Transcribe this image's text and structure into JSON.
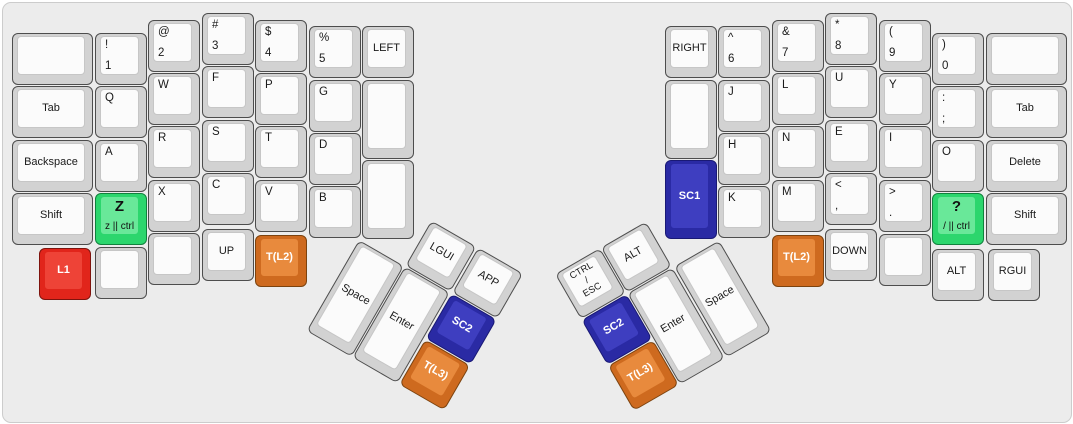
{
  "panel": {
    "bg": "#ececec",
    "border": "#cccccc"
  },
  "colors": {
    "key_base": "#d2d2d2",
    "key_cap": "#fbfbfb",
    "red": "#ee4337",
    "green": "#69e899",
    "orange": "#e88a3d",
    "blue": "#3e3ec0"
  },
  "keys": [
    {
      "name": "key-blank-outer-top-left",
      "x": 9,
      "y": 30,
      "w": 81
    },
    {
      "name": "key-tab-left",
      "x": 9,
      "y": 83,
      "w": 81,
      "center": "Tab"
    },
    {
      "name": "key-backspace",
      "x": 9,
      "y": 137,
      "w": 81,
      "center": "Backspace"
    },
    {
      "name": "key-shift-left",
      "x": 9,
      "y": 190,
      "w": 81,
      "center": "Shift"
    },
    {
      "name": "key-1",
      "x": 92,
      "y": 30,
      "tl": "!",
      "bl": "1"
    },
    {
      "name": "key-q",
      "x": 92,
      "y": 83,
      "tl": "Q"
    },
    {
      "name": "key-a",
      "x": 92,
      "y": 137,
      "tl": "A"
    },
    {
      "name": "key-z-ctrl",
      "x": 92,
      "y": 190,
      "color": "green",
      "big": "Z",
      "sub": "z || ctrl"
    },
    {
      "name": "key-blank-left-col1-bottom",
      "x": 92,
      "y": 244
    },
    {
      "name": "key-2",
      "x": 145,
      "y": 17,
      "tl": "@",
      "bl": "2"
    },
    {
      "name": "key-w",
      "x": 145,
      "y": 70,
      "tl": "W"
    },
    {
      "name": "key-r",
      "x": 145,
      "y": 123,
      "tl": "R"
    },
    {
      "name": "key-x",
      "x": 145,
      "y": 177,
      "tl": "X"
    },
    {
      "name": "key-blank-left-col2-bottom",
      "x": 145,
      "y": 230
    },
    {
      "name": "key-3",
      "x": 199,
      "y": 10,
      "tl": "#",
      "bl": "3"
    },
    {
      "name": "key-f",
      "x": 199,
      "y": 63,
      "tl": "F"
    },
    {
      "name": "key-s",
      "x": 199,
      "y": 117,
      "tl": "S"
    },
    {
      "name": "key-c",
      "x": 199,
      "y": 170,
      "tl": "C"
    },
    {
      "name": "key-up",
      "x": 199,
      "y": 226,
      "center": "UP"
    },
    {
      "name": "key-4",
      "x": 252,
      "y": 17,
      "tl": "$",
      "bl": "4"
    },
    {
      "name": "key-p",
      "x": 252,
      "y": 70,
      "tl": "P"
    },
    {
      "name": "key-t",
      "x": 252,
      "y": 123,
      "tl": "T"
    },
    {
      "name": "key-v",
      "x": 252,
      "y": 177,
      "tl": "V"
    },
    {
      "name": "key-t-l2-left",
      "x": 252,
      "y": 232,
      "color": "orange",
      "center": "T(L2)"
    },
    {
      "name": "key-5",
      "x": 306,
      "y": 23,
      "tl": "%",
      "bl": "5"
    },
    {
      "name": "key-g",
      "x": 306,
      "y": 77,
      "tl": "G"
    },
    {
      "name": "key-d",
      "x": 306,
      "y": 130,
      "tl": "D"
    },
    {
      "name": "key-b",
      "x": 306,
      "y": 183,
      "tl": "B"
    },
    {
      "name": "key-left",
      "x": 359,
      "y": 23,
      "center": "LEFT"
    },
    {
      "name": "key-blank-left-inner-1",
      "x": 359,
      "y": 77,
      "h": 79
    },
    {
      "name": "key-blank-left-inner-2",
      "x": 359,
      "y": 157,
      "h": 79
    },
    {
      "name": "key-l1",
      "x": 36,
      "y": 245,
      "color": "red",
      "center": "L1"
    },
    {
      "name": "key-space-left",
      "x": 356,
      "y": 237,
      "h": 105,
      "rot": 30,
      "ox": 356,
      "oy": 237,
      "center": "Space"
    },
    {
      "name": "key-enter-left",
      "x": 409,
      "y": 237,
      "h": 105,
      "rot": 30,
      "ox": 356,
      "oy": 237,
      "center": "Enter"
    },
    {
      "name": "key-sc2-left",
      "x": 463,
      "y": 237,
      "rot": 30,
      "ox": 356,
      "oy": 237,
      "color": "blue",
      "center": "SC2"
    },
    {
      "name": "key-lgui",
      "x": 409,
      "y": 184,
      "rot": 30,
      "ox": 356,
      "oy": 237,
      "center": "LGUI"
    },
    {
      "name": "key-app",
      "x": 463,
      "y": 184,
      "rot": 30,
      "ox": 356,
      "oy": 237,
      "center": "APP"
    },
    {
      "name": "key-t-l3-left",
      "x": 463,
      "y": 290,
      "rot": 30,
      "ox": 356,
      "oy": 237,
      "color": "orange",
      "center": "T(L3)"
    },
    {
      "name": "key-blank-outer-top-right",
      "x": 983,
      "y": 30,
      "w": 81
    },
    {
      "name": "key-tab-right",
      "x": 983,
      "y": 83,
      "w": 81,
      "center": "Tab"
    },
    {
      "name": "key-delete",
      "x": 983,
      "y": 137,
      "w": 81,
      "center": "Delete"
    },
    {
      "name": "key-shift-right",
      "x": 983,
      "y": 190,
      "w": 81,
      "center": "Shift"
    },
    {
      "name": "key-0",
      "x": 929,
      "y": 30,
      "tl": ")",
      "bl": "0"
    },
    {
      "name": "key-semicolon",
      "x": 929,
      "y": 83,
      "tl": ":",
      "bl": ";"
    },
    {
      "name": "key-o",
      "x": 929,
      "y": 137,
      "tl": "O"
    },
    {
      "name": "key-slash-ctrl",
      "x": 929,
      "y": 190,
      "color": "green",
      "big": "?",
      "sub": "/ || ctrl"
    },
    {
      "name": "key-alt-right",
      "x": 929,
      "y": 246,
      "center": "ALT"
    },
    {
      "name": "key-9",
      "x": 876,
      "y": 17,
      "tl": "(",
      "bl": "9"
    },
    {
      "name": "key-y",
      "x": 876,
      "y": 70,
      "tl": "Y"
    },
    {
      "name": "key-i",
      "x": 876,
      "y": 123,
      "tl": "I"
    },
    {
      "name": "key-period",
      "x": 876,
      "y": 177,
      "tl": ">",
      "bl": "."
    },
    {
      "name": "key-blank-right-col-bottom",
      "x": 876,
      "y": 231
    },
    {
      "name": "key-8",
      "x": 822,
      "y": 10,
      "tl": "*",
      "bl": "8"
    },
    {
      "name": "key-u",
      "x": 822,
      "y": 63,
      "tl": "U"
    },
    {
      "name": "key-e",
      "x": 822,
      "y": 117,
      "tl": "E"
    },
    {
      "name": "key-comma",
      "x": 822,
      "y": 170,
      "tl": "<",
      "bl": ","
    },
    {
      "name": "key-down",
      "x": 822,
      "y": 226,
      "center": "DOWN"
    },
    {
      "name": "key-7",
      "x": 769,
      "y": 17,
      "tl": "&",
      "bl": "7"
    },
    {
      "name": "key-l",
      "x": 769,
      "y": 70,
      "tl": "L"
    },
    {
      "name": "key-n",
      "x": 769,
      "y": 123,
      "tl": "N"
    },
    {
      "name": "key-m",
      "x": 769,
      "y": 177,
      "tl": "M"
    },
    {
      "name": "key-t-l2-right",
      "x": 769,
      "y": 232,
      "color": "orange",
      "center": "T(L2)"
    },
    {
      "name": "key-6",
      "x": 715,
      "y": 23,
      "tl": "^",
      "bl": "6"
    },
    {
      "name": "key-j",
      "x": 715,
      "y": 77,
      "tl": "J"
    },
    {
      "name": "key-h",
      "x": 715,
      "y": 130,
      "tl": "H"
    },
    {
      "name": "key-k",
      "x": 715,
      "y": 183,
      "tl": "K"
    },
    {
      "name": "key-right",
      "x": 662,
      "y": 23,
      "center": "RIGHT"
    },
    {
      "name": "key-blank-right-inner",
      "x": 662,
      "y": 77,
      "h": 79
    },
    {
      "name": "key-sc1",
      "x": 662,
      "y": 157,
      "h": 79,
      "color": "blue",
      "center": "SC1"
    },
    {
      "name": "key-rgui",
      "x": 985,
      "y": 246,
      "center": "RGUI"
    },
    {
      "name": "key-ctrl-esc",
      "x": 557,
      "y": 184,
      "rot": -30,
      "ox": 717,
      "oy": 237,
      "center": "CTRL\n/\nESC"
    },
    {
      "name": "key-alt-thumb-right",
      "x": 610,
      "y": 184,
      "rot": -30,
      "ox": 717,
      "oy": 237,
      "center": "ALT"
    },
    {
      "name": "key-sc2-right",
      "x": 557,
      "y": 237,
      "rot": -30,
      "ox": 717,
      "oy": 237,
      "color": "blue",
      "center": "SC2"
    },
    {
      "name": "key-enter-right",
      "x": 610,
      "y": 237,
      "h": 105,
      "rot": -30,
      "ox": 717,
      "oy": 237,
      "center": "Enter"
    },
    {
      "name": "key-space-right",
      "x": 664,
      "y": 237,
      "h": 105,
      "rot": -30,
      "ox": 717,
      "oy": 237,
      "center": "Space"
    },
    {
      "name": "key-t-l3-right",
      "x": 557,
      "y": 290,
      "rot": -30,
      "ox": 717,
      "oy": 237,
      "color": "orange",
      "center": "T(L3)"
    }
  ]
}
